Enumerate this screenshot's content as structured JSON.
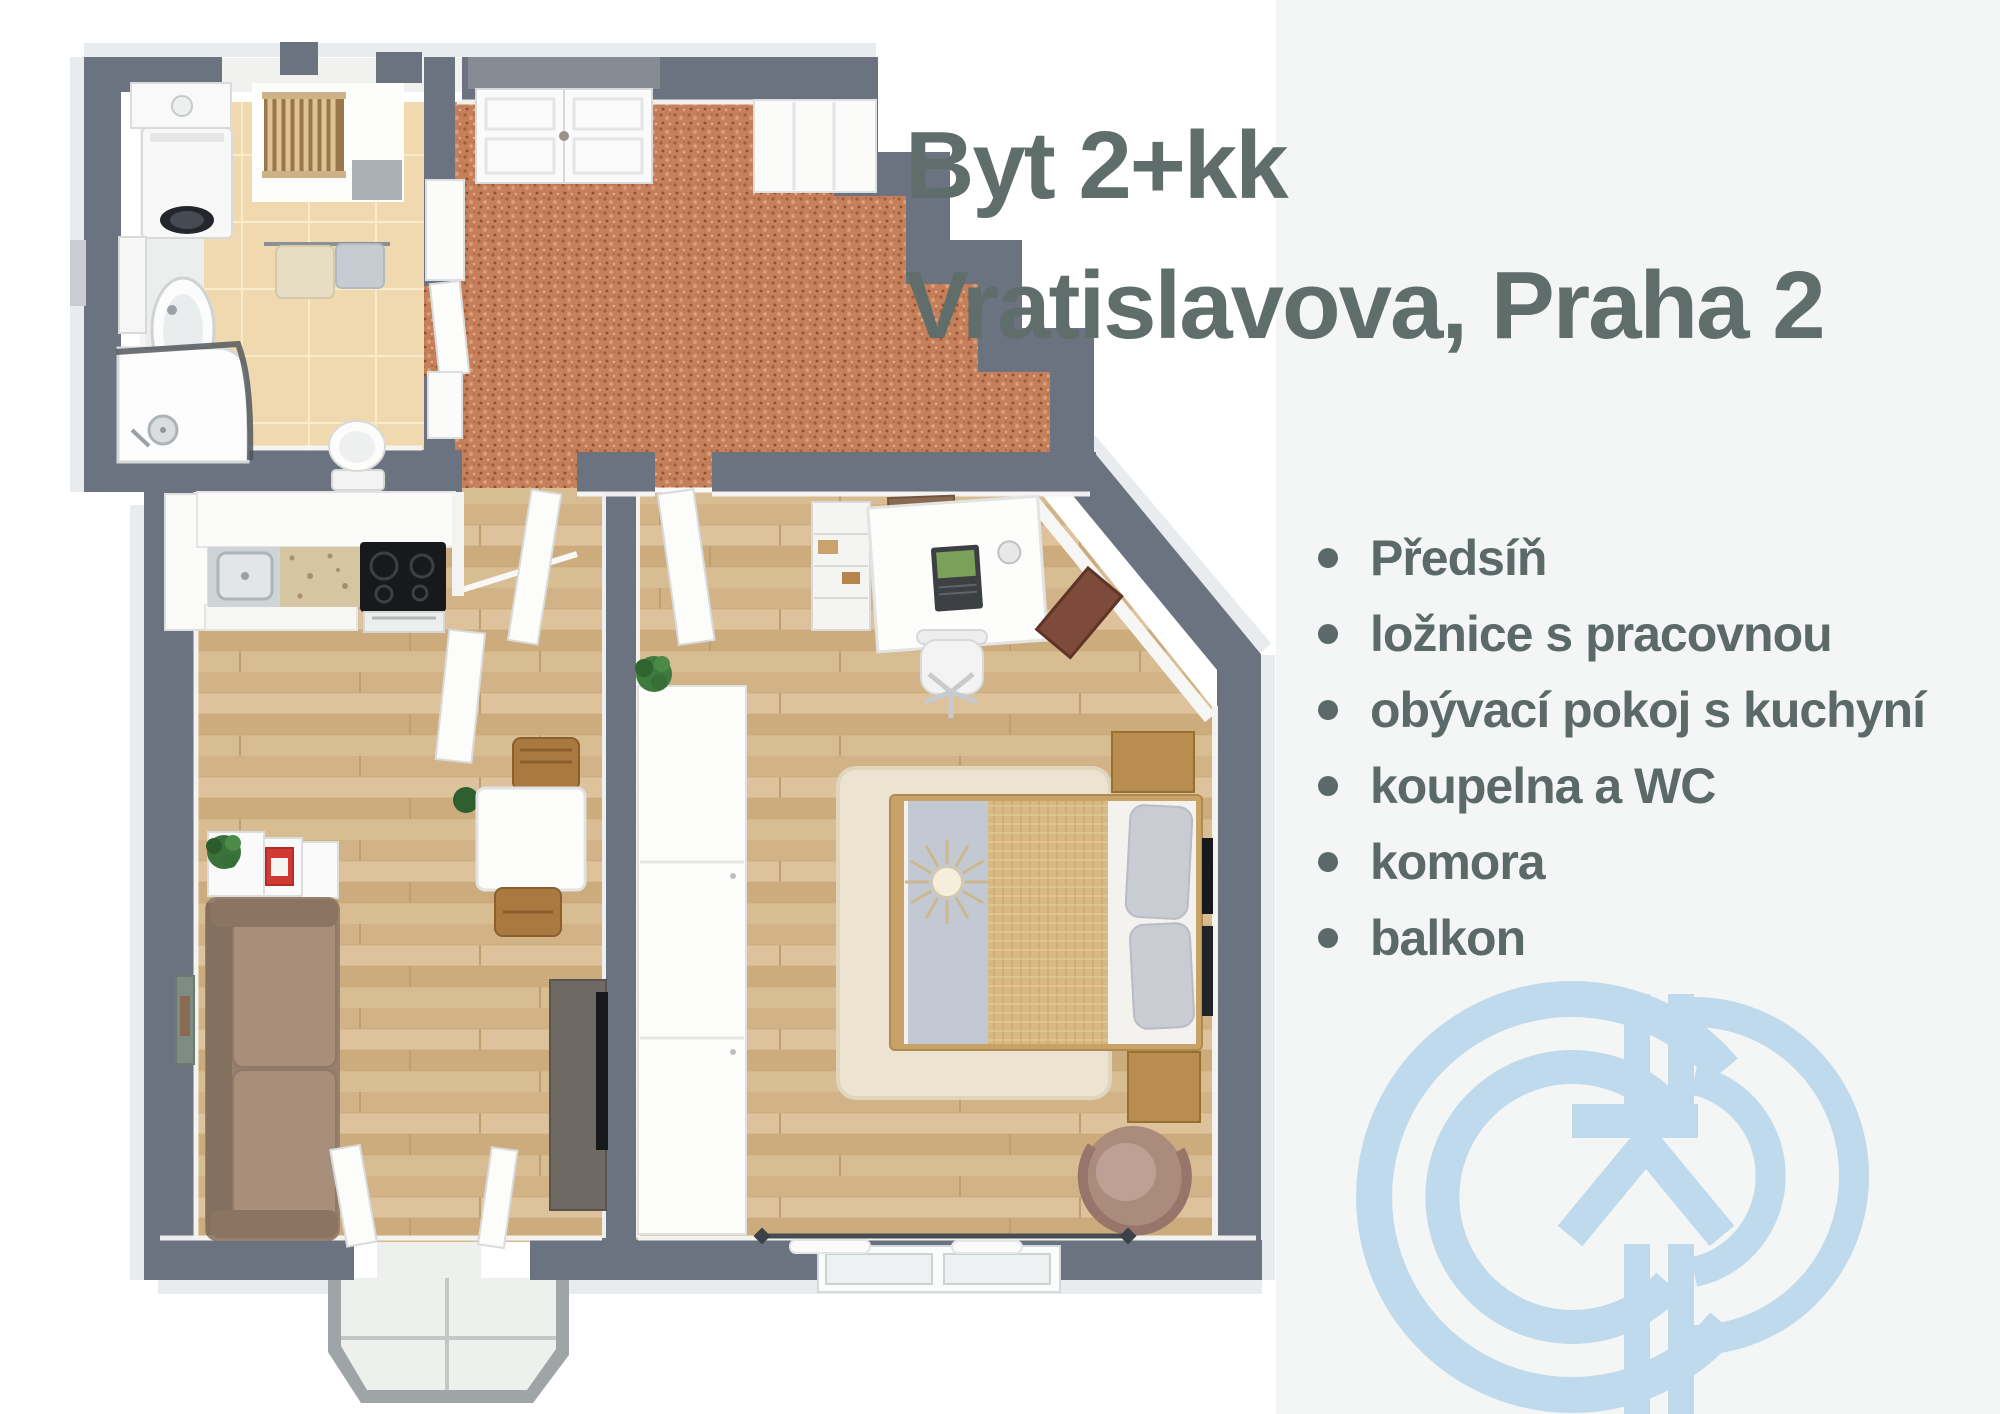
{
  "header": {
    "title_line1": "Byt 2+kk",
    "title_line2": "Vratislavova, Praha 2"
  },
  "features": [
    "Předsíň",
    "ložnice s pracovnou",
    "obývací pokoj s kuchyní",
    "koupelna a WC",
    "komora",
    "balkon"
  ],
  "logo": {
    "icon": "gp-monogram-icon",
    "color": "#bfdaec"
  },
  "colors": {
    "title_text": "#5f6e6b",
    "feature_text": "#5b6a68",
    "wall_gray": "#6c7380",
    "hall_floor_terracotta": "#c57f5a",
    "wood_floor": "#d7ba8f",
    "bathroom_tile": "#f0d9ae",
    "panel_background": "#f4f5f5"
  }
}
